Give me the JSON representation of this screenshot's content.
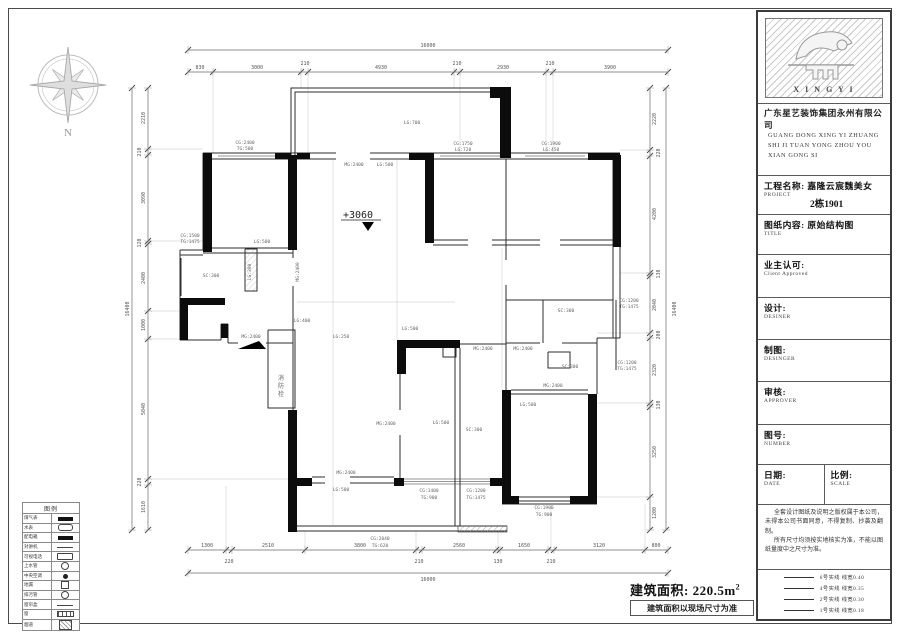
{
  "compass": {
    "label": "N"
  },
  "area": {
    "label": "建筑面积: 220.5m",
    "sup": "2",
    "note": "建筑面积以现场尺寸为准"
  },
  "plan": {
    "level_marker": "+3060",
    "dims": [
      {
        "name": "top-total",
        "orient": "h",
        "line": [
          188,
          50,
          668,
          50
        ],
        "ticks": [
          188,
          668
        ],
        "labels": [
          {
            "t": "16000",
            "x": 428,
            "y": 47
          }
        ]
      },
      {
        "name": "top-seg",
        "orient": "h",
        "line": [
          188,
          72,
          668,
          72
        ],
        "ticks": [
          188,
          213,
          301,
          308,
          454,
          460,
          546,
          553,
          668
        ],
        "labels": [
          {
            "t": "830",
            "x": 200,
            "y": 69
          },
          {
            "t": "3000",
            "x": 257,
            "y": 69
          },
          {
            "t": "210",
            "x": 305,
            "y": 65
          },
          {
            "t": "4930",
            "x": 381,
            "y": 69
          },
          {
            "t": "210",
            "x": 457,
            "y": 65
          },
          {
            "t": "2930",
            "x": 503,
            "y": 69
          },
          {
            "t": "210",
            "x": 550,
            "y": 65
          },
          {
            "t": "3900",
            "x": 610,
            "y": 69
          }
        ]
      },
      {
        "name": "bottom-seg",
        "orient": "h",
        "line": [
          188,
          550,
          668,
          550
        ],
        "ticks": [
          188,
          226,
          232,
          305,
          416,
          422,
          496,
          500,
          548,
          554,
          645,
          668
        ],
        "labels": [
          {
            "t": "1300",
            "x": 207,
            "y": 547
          },
          {
            "t": "2510",
            "x": 268,
            "y": 547
          },
          {
            "t": "3800",
            "x": 360,
            "y": 547
          },
          {
            "t": "2560",
            "x": 459,
            "y": 547
          },
          {
            "t": "1650",
            "x": 524,
            "y": 547
          },
          {
            "t": "3120",
            "x": 599,
            "y": 547
          },
          {
            "t": "800",
            "x": 656,
            "y": 547
          },
          {
            "t": "220",
            "x": 229,
            "y": 563
          },
          {
            "t": "210",
            "x": 419,
            "y": 563
          },
          {
            "t": "130",
            "x": 498,
            "y": 563
          },
          {
            "t": "210",
            "x": 551,
            "y": 563
          }
        ]
      },
      {
        "name": "bottom-total",
        "orient": "h",
        "line": [
          188,
          573,
          668,
          573
        ],
        "ticks": [
          188,
          668
        ],
        "labels": [
          {
            "t": "16000",
            "x": 428,
            "y": 581
          }
        ]
      },
      {
        "name": "left-seg",
        "orient": "v",
        "line": [
          148,
          88,
          148,
          530
        ],
        "ticks": [
          88,
          149,
          155,
          241,
          244,
          311,
          339,
          479,
          485,
          530
        ],
        "labels": [
          {
            "t": "2210",
            "x": 145,
            "y": 118,
            "r": 1
          },
          {
            "t": "210",
            "x": 141,
            "y": 152,
            "r": 1
          },
          {
            "t": "3090",
            "x": 145,
            "y": 198,
            "r": 1
          },
          {
            "t": "120",
            "x": 141,
            "y": 243,
            "r": 1
          },
          {
            "t": "2400",
            "x": 145,
            "y": 278,
            "r": 1
          },
          {
            "t": "1000",
            "x": 145,
            "y": 325,
            "r": 1
          },
          {
            "t": "5040",
            "x": 145,
            "y": 409,
            "r": 1
          },
          {
            "t": "220",
            "x": 141,
            "y": 482,
            "r": 1
          },
          {
            "t": "1610",
            "x": 145,
            "y": 507,
            "r": 1
          }
        ]
      },
      {
        "name": "left-total",
        "orient": "v",
        "line": [
          132,
          88,
          132,
          530
        ],
        "ticks": [
          88,
          530
        ],
        "labels": [
          {
            "t": "16400",
            "x": 129,
            "y": 309,
            "r": 1
          }
        ]
      },
      {
        "name": "right-seg",
        "orient": "v",
        "line": [
          650,
          88,
          650,
          530
        ],
        "ticks": [
          88,
          150,
          156,
          273,
          276,
          333,
          338,
          403,
          407,
          497,
          530
        ],
        "labels": [
          {
            "t": "2220",
            "x": 656,
            "y": 119,
            "r": 1
          },
          {
            "t": "220",
            "x": 660,
            "y": 153,
            "r": 1
          },
          {
            "t": "4200",
            "x": 656,
            "y": 214,
            "r": 1
          },
          {
            "t": "130",
            "x": 660,
            "y": 274,
            "r": 1
          },
          {
            "t": "2040",
            "x": 656,
            "y": 305,
            "r": 1
          },
          {
            "t": "200",
            "x": 660,
            "y": 335,
            "r": 1
          },
          {
            "t": "2320",
            "x": 656,
            "y": 370,
            "r": 1
          },
          {
            "t": "130",
            "x": 660,
            "y": 405,
            "r": 1
          },
          {
            "t": "3250",
            "x": 656,
            "y": 452,
            "r": 1
          },
          {
            "t": "1200",
            "x": 656,
            "y": 513,
            "r": 1
          }
        ]
      },
      {
        "name": "right-total",
        "orient": "v",
        "line": [
          666,
          88,
          666,
          530
        ],
        "ticks": [
          88,
          530
        ],
        "labels": [
          {
            "t": "16400",
            "x": 676,
            "y": 309,
            "r": 1
          }
        ]
      }
    ],
    "labels": [
      {
        "t": "CG:2400",
        "x": 245,
        "y": 144
      },
      {
        "t": "TG:500",
        "x": 245,
        "y": 150
      },
      {
        "t": "LG:700",
        "x": 412,
        "y": 124
      },
      {
        "t": "MG:2400",
        "x": 354,
        "y": 166
      },
      {
        "t": "LG:500",
        "x": 385,
        "y": 166
      },
      {
        "t": "CG:1750",
        "x": 463,
        "y": 145
      },
      {
        "t": "LG:720",
        "x": 463,
        "y": 151
      },
      {
        "t": "CG:1900",
        "x": 551,
        "y": 145
      },
      {
        "t": "LG:450",
        "x": 551,
        "y": 151
      },
      {
        "t": "LG:500",
        "x": 262,
        "y": 243
      },
      {
        "t": "CG:1500",
        "x": 190,
        "y": 237
      },
      {
        "t": "TG:1475",
        "x": 190,
        "y": 243
      },
      {
        "t": "LG:300",
        "x": 251,
        "y": 272,
        "r": 1
      },
      {
        "t": "MG:2400",
        "x": 299,
        "y": 272,
        "r": 1
      },
      {
        "t": "SC:300",
        "x": 211,
        "y": 277
      },
      {
        "t": "LG:400",
        "x": 302,
        "y": 322
      },
      {
        "t": "LG:250",
        "x": 341,
        "y": 338
      },
      {
        "t": "MG:2400",
        "x": 251,
        "y": 338
      },
      {
        "t": "消",
        "x": 281,
        "y": 380,
        "s": 6
      },
      {
        "t": "防",
        "x": 281,
        "y": 388,
        "s": 6
      },
      {
        "t": "栓",
        "x": 281,
        "y": 396,
        "s": 6
      },
      {
        "t": "MG:2400",
        "x": 386,
        "y": 425
      },
      {
        "t": "LG:500",
        "x": 441,
        "y": 424
      },
      {
        "t": "SC:300",
        "x": 474,
        "y": 431
      },
      {
        "t": "MG:2400",
        "x": 483,
        "y": 350
      },
      {
        "t": "MG:2400",
        "x": 523,
        "y": 350
      },
      {
        "t": "SC:300",
        "x": 566,
        "y": 312
      },
      {
        "t": "SC:300",
        "x": 570,
        "y": 368
      },
      {
        "t": "MG:2400",
        "x": 553,
        "y": 387
      },
      {
        "t": "LG:500",
        "x": 528,
        "y": 406
      },
      {
        "t": "CG:1200",
        "x": 629,
        "y": 302
      },
      {
        "t": "TG:1475",
        "x": 629,
        "y": 308
      },
      {
        "t": "CG:1200",
        "x": 627,
        "y": 364
      },
      {
        "t": "TG:1475",
        "x": 627,
        "y": 370
      },
      {
        "t": "MG:2400",
        "x": 346,
        "y": 474
      },
      {
        "t": "LG:500",
        "x": 341,
        "y": 491
      },
      {
        "t": "LG:500",
        "x": 410,
        "y": 330
      },
      {
        "t": "CG:1400",
        "x": 429,
        "y": 492
      },
      {
        "t": "TG:900",
        "x": 429,
        "y": 499
      },
      {
        "t": "CG:1200",
        "x": 476,
        "y": 492
      },
      {
        "t": "TG:1475",
        "x": 476,
        "y": 499
      },
      {
        "t": "CG:1900",
        "x": 544,
        "y": 509
      },
      {
        "t": "TG:900",
        "x": 544,
        "y": 516
      },
      {
        "t": "CG:2040",
        "x": 380,
        "y": 540
      },
      {
        "t": "TG:620",
        "x": 380,
        "y": 547
      }
    ]
  },
  "titleblock": {
    "logo_text": "X I N G Y I",
    "company_cn": "广东星艺装饰集团永州有限公司",
    "company_en": [
      "GUANG DONG XING YI ZHUANG",
      "SHI JI TUAN YONG ZHOU YOU",
      "XIAN GONG SI"
    ],
    "project_label": "工程名称: 嘉隆云宸魏美女",
    "project_sub": "PROJECT",
    "project_no": "2栋1901",
    "sheet_label": "图纸内容: 原始结构图",
    "sheet_sub": "TITLE",
    "rows": [
      {
        "cn": "业主认可:",
        "en": "Client Approved"
      },
      {
        "cn": "设计:",
        "en": "DESINER"
      },
      {
        "cn": "制图:",
        "en": "DESINGER"
      },
      {
        "cn": "审核:",
        "en": "APPROVER"
      },
      {
        "cn": "图号:",
        "en": "NUMBER"
      }
    ],
    "date_cn": "日期:",
    "date_en": "DATE",
    "scale_cn": "比例:",
    "scale_en": "SCALE",
    "notes": [
      "全套设计图纸及说明之版权属于本公司，未得本公司书面同意，不得复制、抄袭及翻制。",
      "所有尺寸均须按实地核实为准，不能以图纸量度中之尺寸为准。"
    ],
    "line_legend": [
      {
        "t": "6号实线 线宽0.40"
      },
      {
        "t": "4号实线 线宽0.35"
      },
      {
        "t": "2号实线 线宽0.30"
      },
      {
        "t": "1号实线 线宽0.18"
      }
    ]
  },
  "legend_table": {
    "title": "图例",
    "rows": [
      {
        "label": "煤气表",
        "sym": "bar"
      },
      {
        "label": "水表",
        "sym": "oval"
      },
      {
        "label": "配电箱",
        "sym": "bar"
      },
      {
        "label": "对讲机",
        "sym": "line"
      },
      {
        "label": "可视电话",
        "sym": "oval2"
      },
      {
        "label": "上水管",
        "sym": "circle"
      },
      {
        "label": "中央空调",
        "sym": "dot"
      },
      {
        "label": "地漏",
        "sym": "square"
      },
      {
        "label": "排污管",
        "sym": "circle"
      },
      {
        "label": "窗帘盒",
        "sym": "line"
      },
      {
        "label": "窗",
        "sym": "window"
      },
      {
        "label": "烟道",
        "sym": "hatch"
      }
    ]
  }
}
